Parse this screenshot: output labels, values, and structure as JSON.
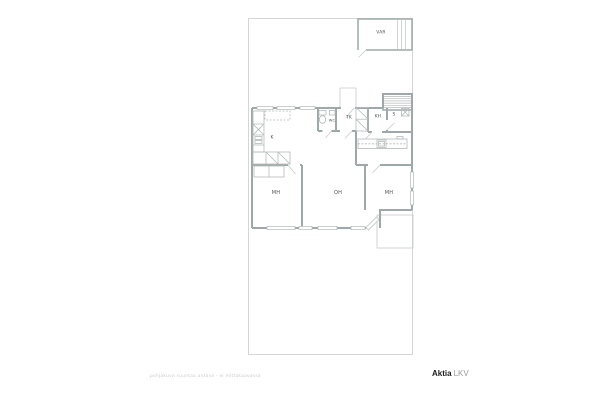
{
  "floorplan": {
    "rooms": [
      {
        "id": "storage",
        "label": "VAR"
      },
      {
        "id": "kitchen",
        "label": "K"
      },
      {
        "id": "toilet",
        "label": "WC"
      },
      {
        "id": "entry",
        "label": "TK"
      },
      {
        "id": "bathroom",
        "label": "KH"
      },
      {
        "id": "sauna",
        "label": "S"
      },
      {
        "id": "bedroom-left",
        "label": "MH"
      },
      {
        "id": "living-room",
        "label": "OH"
      },
      {
        "id": "bedroom-right",
        "label": "MH"
      }
    ],
    "disclaimer": "pohjakuva suuntaa antava - ei mittakaavassa",
    "brand": {
      "name": "Aktia",
      "suffix": "LKV"
    },
    "colors": {
      "wall": "#9fa8a8",
      "thin_line": "#c7cccb",
      "hatch": "#b4bbba",
      "label": "#4d5456",
      "disclaimer": "#cccccc",
      "brand_dark": "#1c1c1c",
      "brand_gray": "#9a9a9a"
    }
  }
}
